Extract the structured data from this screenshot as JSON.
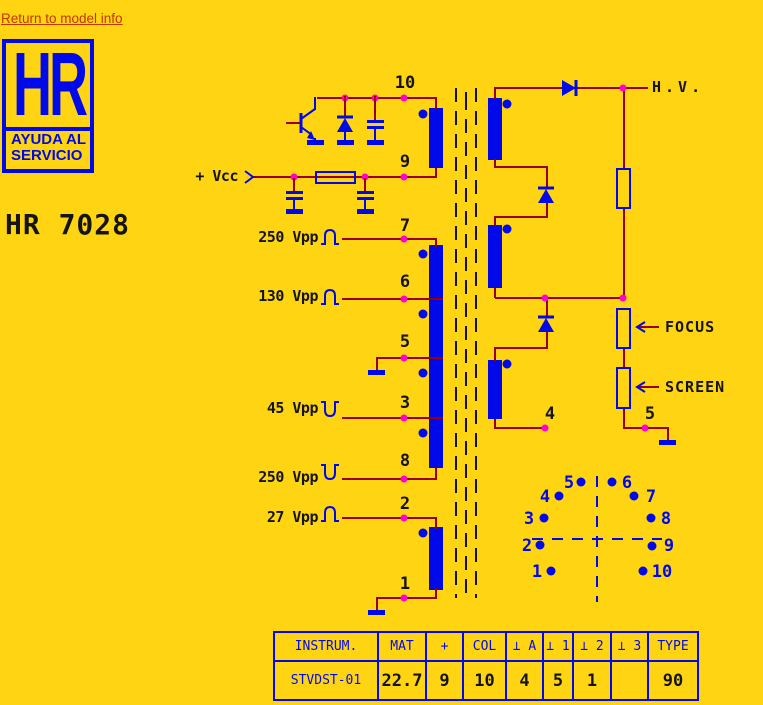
{
  "link": {
    "label": "Return to model info"
  },
  "logo": {
    "monogram": "HR",
    "subtitle1": "AYUDA AL",
    "subtitle2": "SERVICIO"
  },
  "title": "HR 7028",
  "colors": {
    "background": "#ffd513",
    "blue": "#0009e8",
    "wire": "#9b0000",
    "junction_dot": "#ff00d0",
    "link": "#c53500",
    "text": "#141414"
  },
  "schematic": {
    "supply_label": "+ Vcc",
    "hv_label": "H.V.",
    "focus_label": "FOCUS",
    "screen_label": "SCREEN",
    "left_pins": [
      "10",
      "9",
      "7",
      "6",
      "5",
      "3",
      "8",
      "2",
      "1"
    ],
    "right_pins": [
      "4",
      "5"
    ],
    "signals": [
      {
        "label": "250 Vpp",
        "pulse": "positive"
      },
      {
        "label": "130 Vpp",
        "pulse": "positive"
      },
      {
        "label": "45 Vpp",
        "pulse": "negative"
      },
      {
        "label": "250 Vpp",
        "pulse": "negative"
      },
      {
        "label": "27 Vpp",
        "pulse": "positive"
      }
    ]
  },
  "pinout": {
    "labels": [
      "1",
      "2",
      "3",
      "4",
      "5",
      "6",
      "7",
      "8",
      "9",
      "10"
    ]
  },
  "table": {
    "headers": [
      "INSTRUM.",
      "MAT",
      "+",
      "COL",
      "⊥ A",
      "⊥ 1",
      "⊥ 2",
      "⊥ 3",
      "TYPE"
    ],
    "row": [
      "STVDST-01",
      "22.7",
      "9",
      "10",
      "4",
      "5",
      "1",
      "",
      "90"
    ]
  }
}
